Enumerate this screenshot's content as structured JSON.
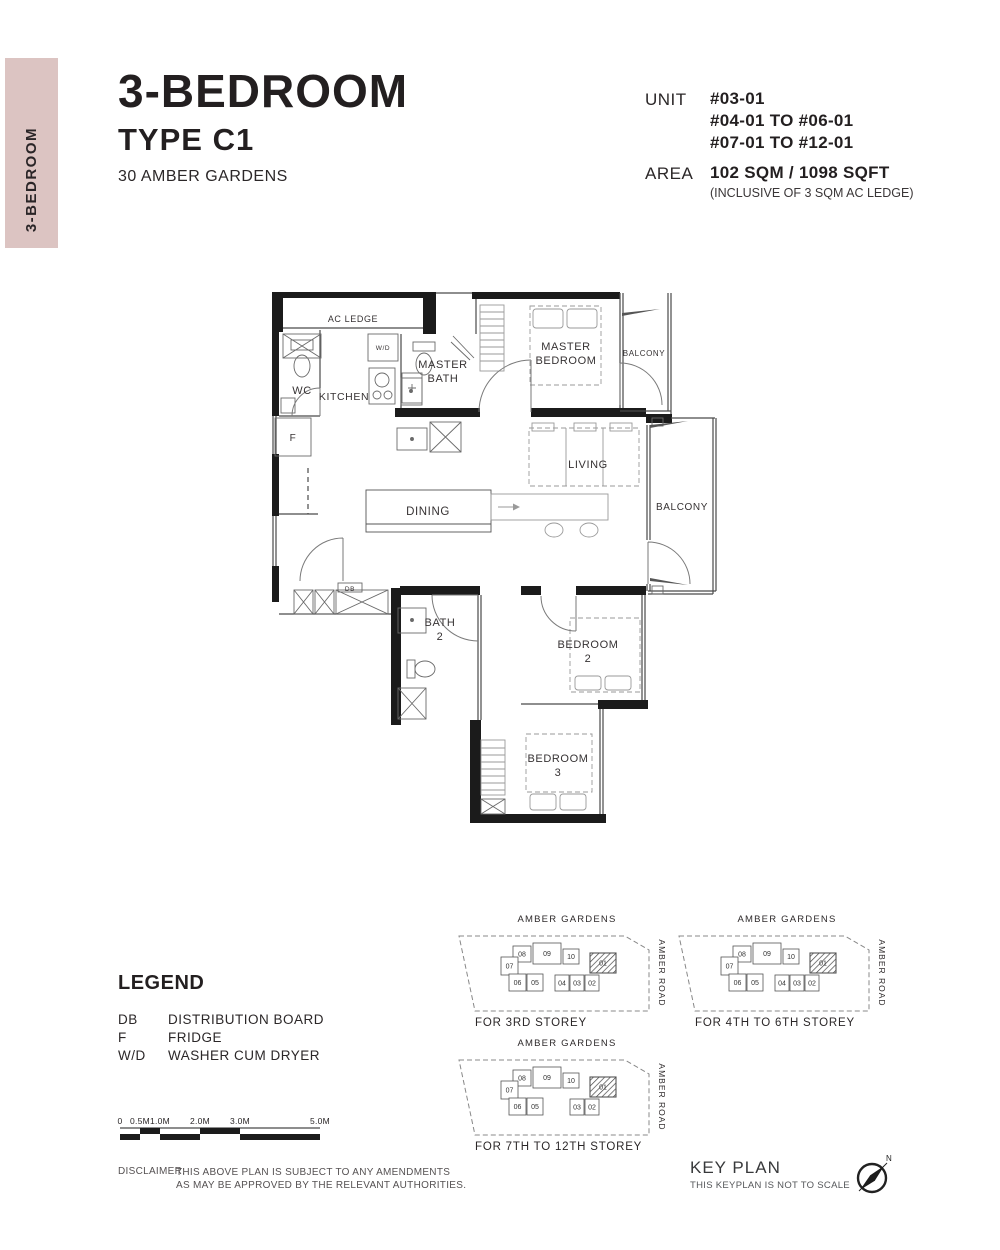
{
  "sidebar_tab": {
    "label": "3-BEDROOM",
    "color": "#dcc4c2"
  },
  "header": {
    "title": "3-BEDROOM",
    "subtitle": "TYPE C1",
    "address": "30 AMBER GARDENS"
  },
  "unit_info": {
    "label": "UNIT",
    "values": [
      "#03-01",
      "#04-01 TO #06-01",
      "#07-01 TO #12-01"
    ]
  },
  "area_info": {
    "label": "AREA",
    "value": "102 SQM / 1098 SQFT",
    "note": "(INCLUSIVE OF 3 SQM AC LEDGE)"
  },
  "floorplan": {
    "rooms": [
      {
        "id": "ac-ledge",
        "lines": [
          "AC LEDGE"
        ],
        "x": 95,
        "y": 44,
        "size": 9
      },
      {
        "id": "wc",
        "lines": [
          "WC"
        ],
        "x": 44,
        "y": 116,
        "size": 11
      },
      {
        "id": "kitchen",
        "lines": [
          "KITCHEN"
        ],
        "x": 86,
        "y": 122,
        "size": 10.5
      },
      {
        "id": "washer-dryer",
        "lines": [
          "W/D"
        ],
        "x": 125,
        "y": 72,
        "size": 6.5
      },
      {
        "id": "master-bath",
        "lines": [
          "MASTER",
          "BATH"
        ],
        "x": 185,
        "y": 90,
        "size": 11
      },
      {
        "id": "master-bedroom",
        "lines": [
          "MASTER",
          "BEDROOM"
        ],
        "x": 308,
        "y": 72,
        "size": 11
      },
      {
        "id": "balcony-top",
        "lines": [
          "BALCONY"
        ],
        "x": 386,
        "y": 78,
        "size": 8
      },
      {
        "id": "living",
        "lines": [
          "LIVING"
        ],
        "x": 330,
        "y": 190,
        "size": 11
      },
      {
        "id": "dining",
        "lines": [
          "DINING"
        ],
        "x": 170,
        "y": 237,
        "size": 11.5
      },
      {
        "id": "balcony-right",
        "lines": [
          "BALCONY"
        ],
        "x": 424,
        "y": 232,
        "size": 10
      },
      {
        "id": "fridge",
        "lines": [
          "F"
        ],
        "x": 35,
        "y": 163,
        "size": 10
      },
      {
        "id": "db",
        "lines": [
          "DB"
        ],
        "x": 92,
        "y": 313,
        "size": 6.5
      },
      {
        "id": "bath-2",
        "lines": [
          "BATH",
          "2"
        ],
        "x": 182,
        "y": 348,
        "size": 11
      },
      {
        "id": "bedroom-2",
        "lines": [
          "BEDROOM",
          "2"
        ],
        "x": 330,
        "y": 370,
        "size": 11
      },
      {
        "id": "bedroom-3",
        "lines": [
          "BEDROOM",
          "3"
        ],
        "x": 300,
        "y": 484,
        "size": 11
      }
    ]
  },
  "legend": {
    "title": "LEGEND",
    "items": [
      {
        "abbr": "DB",
        "desc": "DISTRIBUTION BOARD"
      },
      {
        "abbr": "F",
        "desc": "FRIDGE"
      },
      {
        "abbr": "W/D",
        "desc": "WASHER CUM DRYER"
      }
    ]
  },
  "scale_bar": {
    "labels": [
      {
        "text": "0",
        "m": 0
      },
      {
        "text": "0.5M",
        "m": 0.5
      },
      {
        "text": "1.0M",
        "m": 1
      },
      {
        "text": "2.0M",
        "m": 2
      },
      {
        "text": "3.0M",
        "m": 3
      },
      {
        "text": "5.0M",
        "m": 5
      }
    ],
    "segments": [
      {
        "from": 0,
        "to": 0.5,
        "level": "low"
      },
      {
        "from": 0.5,
        "to": 1,
        "level": "high"
      },
      {
        "from": 1,
        "to": 2,
        "level": "low"
      },
      {
        "from": 2,
        "to": 3,
        "level": "high"
      },
      {
        "from": 3,
        "to": 5,
        "level": "low"
      }
    ]
  },
  "disclaimer": {
    "label": "DISCLAIMER:",
    "lines": [
      "THIS ABOVE PLAN IS SUBJECT TO ANY AMENDMENTS",
      "AS MAY BE APPROVED BY THE RELEVANT AUTHORITIES."
    ]
  },
  "key_plans": [
    {
      "street_top": "AMBER GARDENS",
      "street_right": "AMBER ROAD",
      "caption": "FOR 3RD STOREY",
      "units": [
        "08",
        "09",
        "10",
        "07",
        "01",
        "06",
        "05",
        "04",
        "03",
        "02"
      ],
      "highlight": "01"
    },
    {
      "street_top": "AMBER GARDENS",
      "street_right": "AMBER ROAD",
      "caption": "FOR 4TH TO 6TH STOREY",
      "units": [
        "08",
        "09",
        "10",
        "07",
        "01",
        "06",
        "05",
        "04",
        "03",
        "02"
      ],
      "highlight": "01"
    },
    {
      "street_top": "AMBER GARDENS",
      "street_right": "AMBER ROAD",
      "caption": "FOR 7TH TO 12TH STOREY",
      "units": [
        "08",
        "09",
        "10",
        "07",
        "01",
        "06",
        "05",
        "03",
        "02"
      ],
      "highlight": "01"
    }
  ],
  "key_plan_block": {
    "title": "KEY PLAN",
    "note": "THIS KEYPLAN IS NOT TO SCALE",
    "compass_label": "N"
  }
}
